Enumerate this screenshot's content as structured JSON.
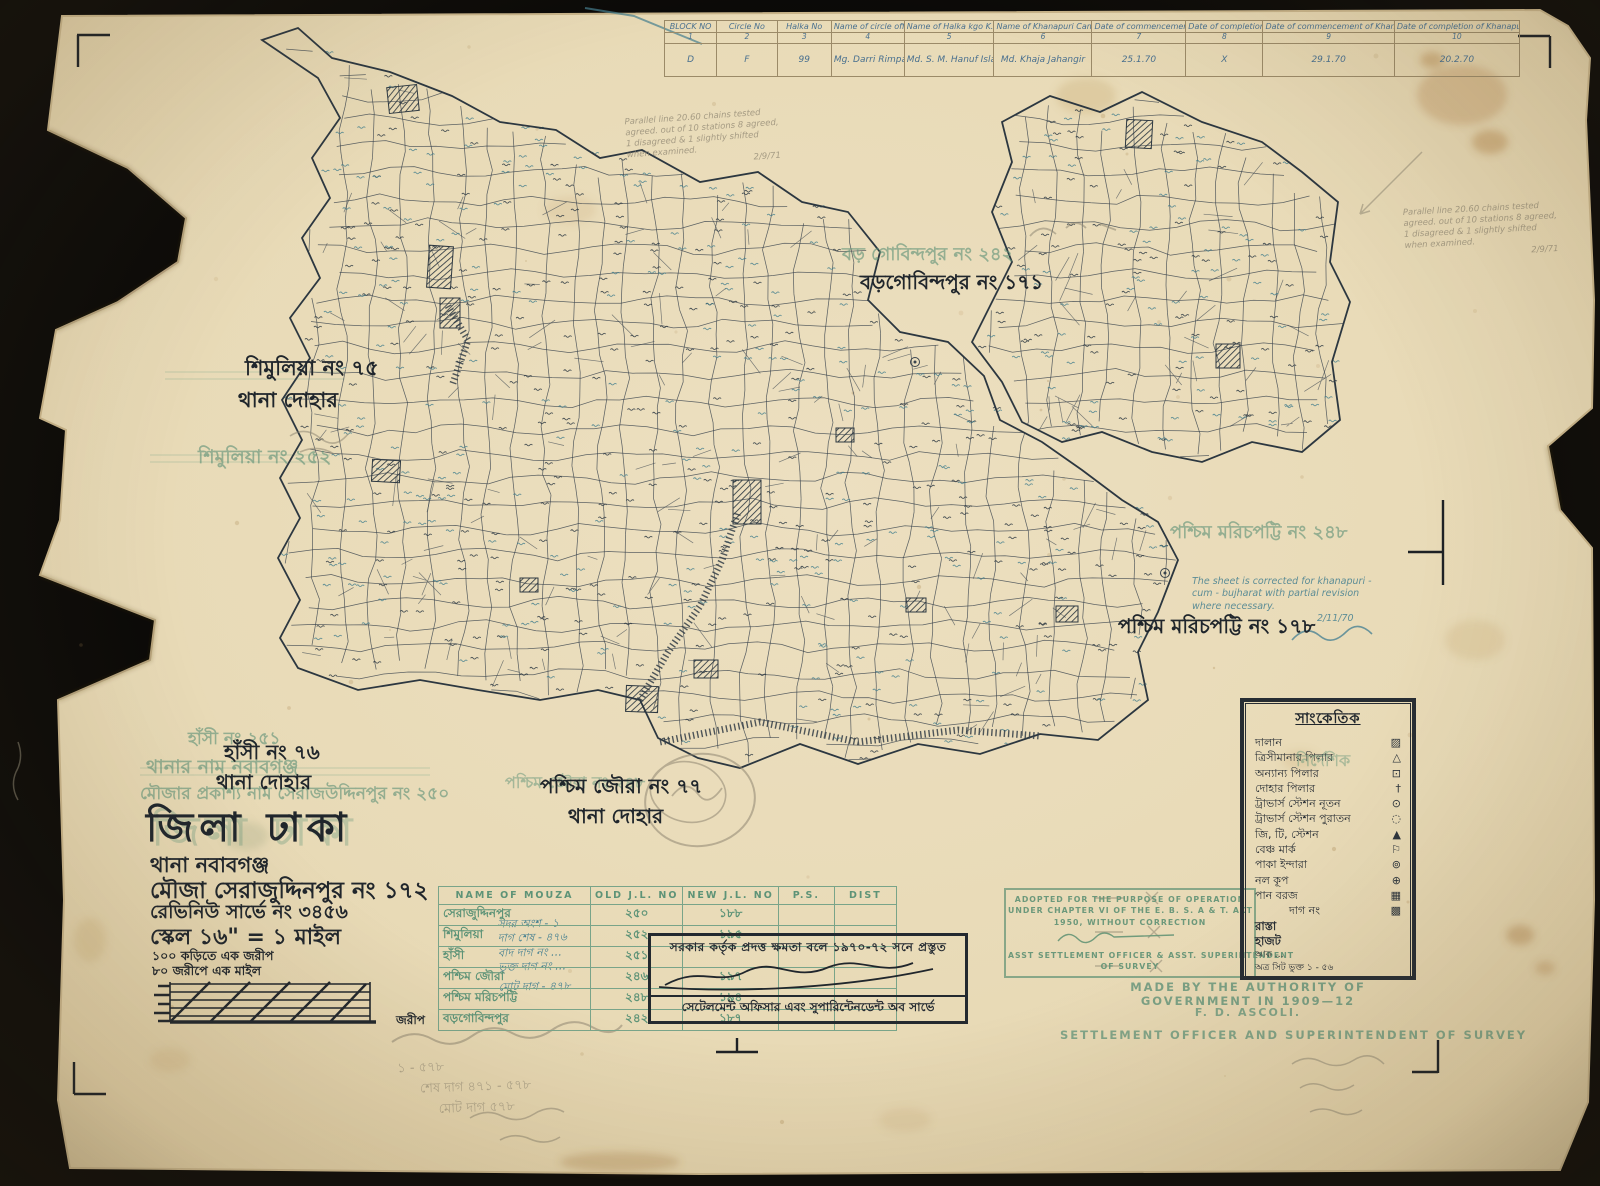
{
  "colors": {
    "paper": "#e8dab6",
    "backdrop": "#0b0a08",
    "map_ink": "#39444e",
    "black_ink": "#20262c",
    "teal_ink": "#447f90",
    "stamp_green": "#5f9278",
    "pencil": "#8e8672"
  },
  "top_table": {
    "headers": [
      "BLOCK NO",
      "Circle No",
      "Halka No",
      "Name of circle officer",
      "Name of Halka kgo K.S.O",
      "Name of Khanapuri Camp i/c & Amin",
      "Date of commencement of Pudding",
      "Date of completion of attestation",
      "Date of commencement of Khanapuri cum Bujharat with Parcha",
      "Date of completion of Khanapuri cum attestation"
    ],
    "col_numbers": [
      "1",
      "2",
      "3",
      "4",
      "5",
      "6",
      "7",
      "8",
      "9",
      "10"
    ],
    "row": [
      "D",
      "F",
      "99",
      "Mg. Darri Rimpa chakherbad A.S.O",
      "Md. S. M. Hanuf Islam Sder Khal",
      "Md. Khaja Jahangir",
      "25.1.70",
      "X",
      "29.1.70",
      "20.2.70"
    ]
  },
  "map_labels": {
    "shimulia_black_1": "শিমুলিয়া নং ৭৫",
    "shimulia_black_2": "থানা দোহার",
    "shimulia_green": "শিমুলিয়া নং ২৫২",
    "borogobindopur_green": "বড় গোবিন্দপুর নং ২৪২",
    "borogobindopur_black": "বড়গোবিন্দপুর নং ১৭১",
    "morichpotti_green": "পশ্চিম মরিচপট্টি নং ২৪৮",
    "morichpotti_black": "পশ্চিম মরিচপট্টি নং ১৭৮",
    "joura_green": "পশ্চিম জৌরা নং ২৪৮",
    "joura_black_1": "পশ্চিম জৌরা নং ৭৭",
    "joura_black_2": "থানা দোহার",
    "hasi_green": "হাঁসী নং ২৫১",
    "thana_green": "থানার নাম নবাবগঞ্জ",
    "prokashyo_green": "মৌজার প্রকাশ্য নাম সেরাজউদ্দিনপুর নং ২৫০",
    "hasi_black_1": "হাঁসী নং ৭৬",
    "hasi_black_2": "থানা দোহার"
  },
  "title_block": {
    "district": "জিলা ঢাকা",
    "thana": "থানা   নবাবগঞ্জ",
    "mouza": "মৌজা  সেরাজুদ্দিনপুর নং ১৭২",
    "revenue": "রেভিনিউ সার্ভে নং ৩৪৫৬",
    "scale": "স্কেল ১৬\" = ১ মাইল",
    "scale_note1": "১০০ কড়িতে এক জরীপ",
    "scale_note2": "৮০ জরীপে এক মাইল",
    "jorip_label": "জরীপ"
  },
  "blue_tally": [
    "সদর অংশ - ১",
    "দাগ শেষ - ৪৭৬",
    "বাদ দাগ নং …",
    "ভুক্ত দাগ নং …",
    "মোট দাগ - ৪৭৮"
  ],
  "pencil_tally": [
    "১ - ৫৭৮",
    "শেষ দাগ ৪৭১ - ৫৭৮",
    "মোট দাগ ৫৭৮"
  ],
  "mouza_table": {
    "headers": [
      "NAME OF MOUZA",
      "OLD J.L. NO",
      "NEW J.L. NO",
      "P.S.",
      "DIST"
    ],
    "rows": [
      {
        "name": "সেরাজুদ্দিনপুর",
        "old": "২৫০",
        "new": "১৮৮",
        "ps": "",
        "dist": ""
      },
      {
        "name": "শিমুলিয়া",
        "old": "২৫২",
        "new": "১৯৫",
        "ps": "",
        "dist": ""
      },
      {
        "name": "হাঁসী",
        "old": "২৫১",
        "new": "",
        "ps": "",
        "dist": ""
      },
      {
        "name": "পশ্চিম জৌরা",
        "old": "২৪৬",
        "new": "১৯৭",
        "ps": "",
        "dist": ""
      },
      {
        "name": "পশ্চিম মরিচপট্টি",
        "old": "২৪৮",
        "new": "১৯৪",
        "ps": "",
        "dist": ""
      },
      {
        "name": "বড়গোবিন্দপুর",
        "old": "২৪২",
        "new": "১৮৭",
        "ps": "",
        "dist": ""
      }
    ]
  },
  "black_stamp": {
    "line1": "সরকার কর্তৃক প্রদত্ত ক্ষমতা বলে ১৯৭০-৭২ সনে প্রস্তুত",
    "line2": "সেটেলমেন্ট অফিসার এবং সুপারিন্টেনডেন্ট অব সার্ভে"
  },
  "green_stamp": {
    "line1": "ADOPTED FOR THE PURPOSE OF OPERATION",
    "line2": "UNDER CHAPTER VI OF THE E. B. S. A & T. ACT",
    "line3": "1950, WITHOUT CORRECTION",
    "line4": "ASST SETTLEMENT OFFICER & ASST. SUPERINTENDENT",
    "line5": "OF SURVEY"
  },
  "authority": {
    "line1": "MADE BY THE AUTHORITY OF GOVERNMENT IN 1909—12",
    "line2": "F. D. ASCOLI.",
    "line3": "SETTLEMENT OFFICER AND SUPERINTENDENT OF SURVEY"
  },
  "legend": {
    "title": "সাংকেতিক",
    "ghost": "নির্দেশিক",
    "items": [
      {
        "label": "দালান",
        "symbol": "▨"
      },
      {
        "label": "ত্রিসীমানার পিলার",
        "symbol": "△"
      },
      {
        "label": "অন্যান্য পিলার",
        "symbol": "⊡"
      },
      {
        "label": "দোহার পিলার",
        "symbol": "†"
      },
      {
        "label": "ট্রাভার্স স্টেশন নূতন",
        "symbol": "⊙"
      },
      {
        "label": "ট্রাভার্স স্টেশন পুরাতন",
        "symbol": "◌"
      },
      {
        "label": "জি, টি, স্টেশন",
        "symbol": "▲"
      },
      {
        "label": "বেঞ্চ মার্ক",
        "symbol": "⚐"
      },
      {
        "label": "পাকা ইন্দারা",
        "symbol": "⊚"
      },
      {
        "label": "নল কূপ",
        "symbol": "⊕"
      },
      {
        "label": "পান বরজ",
        "symbol": "▦"
      },
      {
        "label": "দাগ নং",
        "symbol": "▩"
      }
    ],
    "extra1": "রাস্তা",
    "extra2": "হাজট",
    "aak": "আক …",
    "sheet_line": "অত্র সিট ভুক্ত ১ - ৫৬"
  },
  "blue_note": {
    "l1": "The sheet is corrected for khanapuri -",
    "l2": "cum - bujharat with partial revision",
    "l3": "where necessary.",
    "date": "2/11/70"
  },
  "pencil_note": {
    "l1": "Parallel line 20.60 chains tested",
    "l2": "agreed. out of 10 stations 8 agreed,",
    "l3": "1 disagreed & 1 slightly shifted",
    "l4": "when examined.",
    "date": "2/9/71"
  }
}
